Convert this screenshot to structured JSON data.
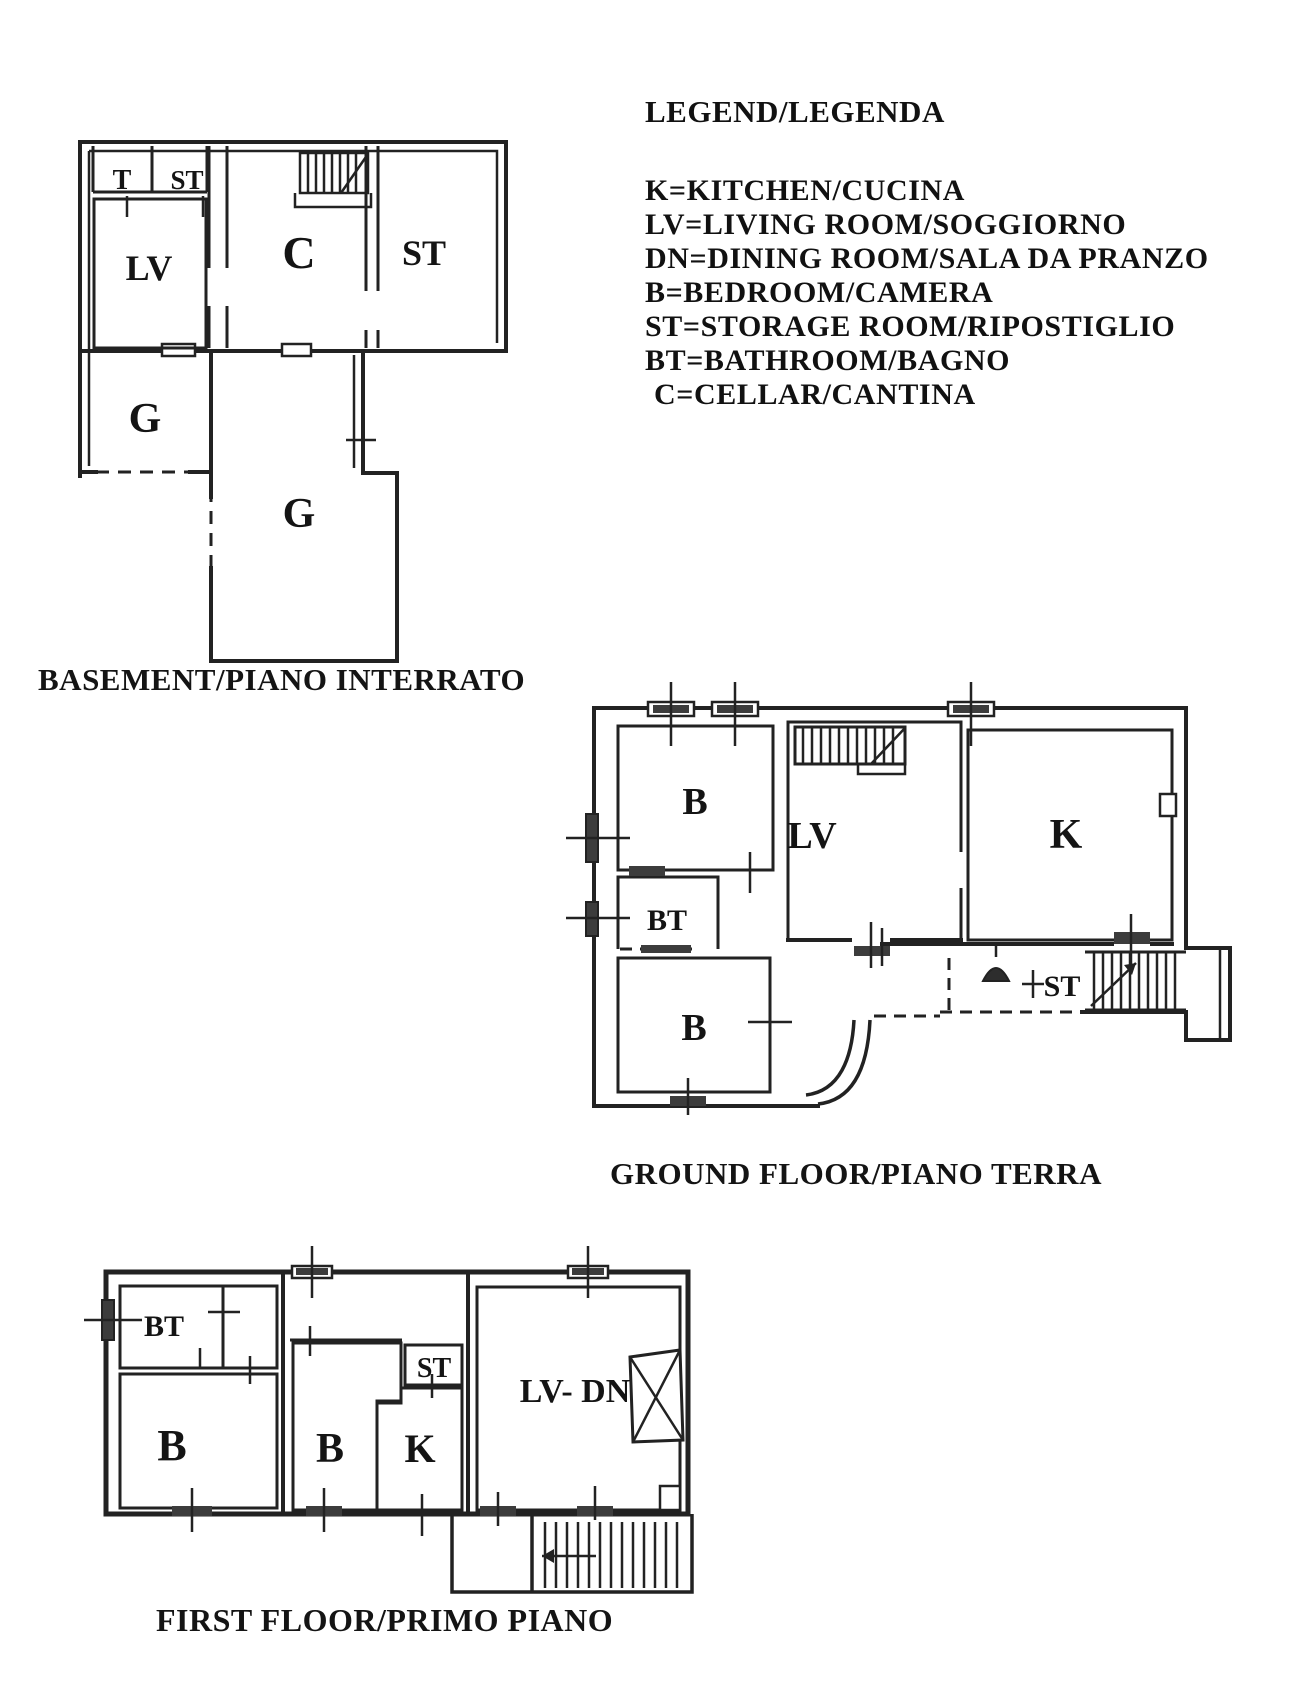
{
  "page": {
    "background": "#ffffff",
    "ink": "#222222"
  },
  "legend": {
    "title": "LEGEND/LEGENDA",
    "items": [
      "K=KITCHEN/CUCINA",
      "LV=LIVING ROOM/SOGGIORNO",
      "DN=DINING ROOM/SALA DA PRANZO",
      "B=BEDROOM/CAMERA",
      "ST=STORAGE ROOM/RIPOSTIGLIO",
      "BT=BATHROOM/BAGNO",
      "C=CELLAR/CANTINA"
    ]
  },
  "floors": {
    "basement": {
      "caption": "BASEMENT/PIANO INTERRATO",
      "labels": {
        "t": "T",
        "st_small": "ST",
        "lv": "LV",
        "c": "C",
        "st": "ST",
        "g_left": "G",
        "g_main": "G"
      }
    },
    "ground": {
      "caption": "GROUND FLOOR/PIANO TERRA",
      "labels": {
        "b_top": "B",
        "bt": "BT",
        "b_bottom": "B",
        "lv": "LV",
        "k": "K",
        "st": "ST"
      }
    },
    "first": {
      "caption": "FIRST FLOOR/PRIMO PIANO",
      "labels": {
        "bt": "BT",
        "b_left": "B",
        "b_mid": "B",
        "st": "ST",
        "k": "K",
        "lv_dn": "LV- DN"
      }
    }
  }
}
